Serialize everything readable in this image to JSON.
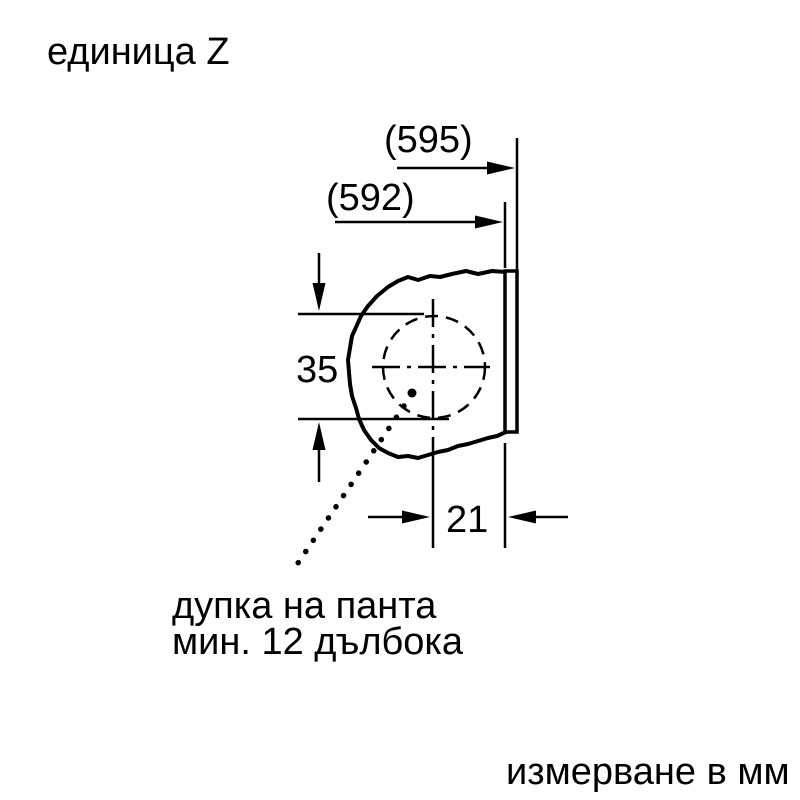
{
  "title": "единица Z",
  "footer": "измерване в мм",
  "dimensions": {
    "overall_width": "(595)",
    "body_width": "(592)",
    "hole_diameter": "35",
    "hole_offset": "21"
  },
  "label": {
    "line1": "дупка на панта",
    "line2": "мин. 12 дълбока"
  },
  "colors": {
    "ink": "#000000",
    "background": "#ffffff"
  }
}
